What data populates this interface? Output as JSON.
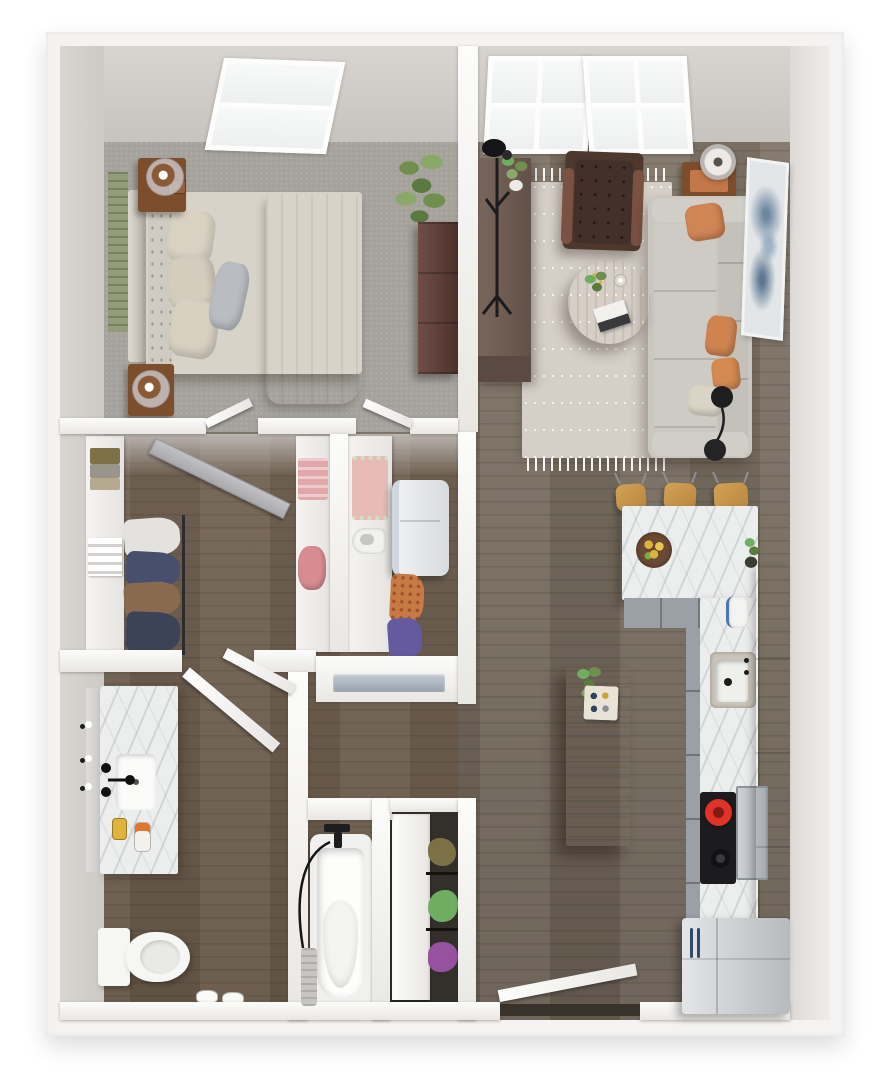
{
  "view": {
    "type": "3d-top-down-floor-plan-render",
    "background": "#ffffff",
    "visible_text": "none"
  },
  "rooms": {
    "bedroom": {
      "name": "Bedroom",
      "items": [
        "bed with cream bedding and tan blanket",
        "headboard",
        "green wall panel",
        "two wood nightstands with glass lamps",
        "dark dresser",
        "potted plant",
        "skylight window"
      ]
    },
    "living": {
      "name": "Living room",
      "items": [
        "gray sofa with orange pillows",
        "brown tufted armchair",
        "round oak coffee table",
        "patterned rug with fringe",
        "side table with lamp",
        "media console with plant",
        "coat rack",
        "arc floor lamp",
        "wall art",
        "double window"
      ]
    },
    "closet": {
      "name": "Walk-in closet",
      "items": [
        "hanging clothes",
        "folded linens",
        "shelving",
        "gray door"
      ]
    },
    "laundry": {
      "name": "Laundry closet",
      "items": [
        "washer",
        "iron",
        "pink blanket",
        "hanging clothes"
      ]
    },
    "bathroom": {
      "name": "Bathroom",
      "items": [
        "marble vanity with sink",
        "mirror and sconces",
        "toilet",
        "slippers",
        "bathtub with hand shower",
        "towel"
      ]
    },
    "linen": {
      "name": "Linen closet",
      "items": [
        "white door",
        "shelves with towels and plants"
      ]
    },
    "kitchen": {
      "name": "Kitchen",
      "items": [
        "L-shaped marble counter",
        "three bar stools",
        "fruit bowl",
        "sink",
        "kettle",
        "cooktop with red pot",
        "oven panel",
        "tall white cabinets",
        "stainless refrigerator",
        "wood island with plant and jars"
      ]
    },
    "entry": {
      "name": "Entry",
      "items": [
        "open front door",
        "dark threshold"
      ]
    }
  },
  "palette": {
    "outerWall": "#f4f3f1",
    "wallHi": "#fcfcfb",
    "wallLo": "#e9e7e3",
    "faceHi": "#d8d5d1",
    "faceLo": "#c7c3bf",
    "floorMain": "#7b6f61",
    "carpet": "#a5a29c",
    "rug": "#d5cfc7",
    "sofa": "#c9c7bf",
    "sofaTrim": "#b2b0a7",
    "pillowOrange": "#d08554",
    "pillowCream": "#dad4c6",
    "pillowGray": "#b9bdc2",
    "armchair": "#4e382e",
    "armchairArm": "#7b5242",
    "woodWarm": "#7d4e2b",
    "console": "#6f5c51",
    "consoleDark": "#5a4a41",
    "dresser": "#5f3a33",
    "island": "#b08a5c",
    "stool": "#c99a52",
    "coffeeTable": "#c5a066",
    "marble": "#eceded",
    "cabinetGray": "#9aa0a6",
    "cabinetWhite": "#f0f1f2",
    "fridgeHi": "#e3e5e7",
    "fridgeLo": "#b7babd",
    "ovenPanel": "#b5bac0",
    "potRed": "#e03226",
    "ink": "#1d1d1f",
    "plantDark": "#5c7a40",
    "plantMid": "#6f8f4f",
    "plantLight": "#89a968",
    "greenPanel": "#949b77",
    "bedLinen": "#d8d3c8",
    "blanket": "#cdbfa9",
    "pink": "#e2a7ab",
    "pinkDeep": "#d88c92",
    "blanketPink": "#e7bcb8",
    "doorGray": "#b6b6ba",
    "porcelain": "#f6f6f4",
    "vent": "#aeb8c2",
    "sink": "#c9c4ba",
    "olive": "#7c7146",
    "leafGreen": "#6fae62",
    "purple": "#96519f",
    "orangeCloth": "#c87a44",
    "navyCloth": "#474e6e",
    "brownCloth": "#8a6a4e",
    "purpleCloth": "#655aa0",
    "whiteCloth": "#e3e2de",
    "towel": "#c6c5c2",
    "artBlue": "#6c87a0",
    "threshold": "#39322b",
    "gold": "#e0b43c",
    "orange": "#e0762e"
  }
}
